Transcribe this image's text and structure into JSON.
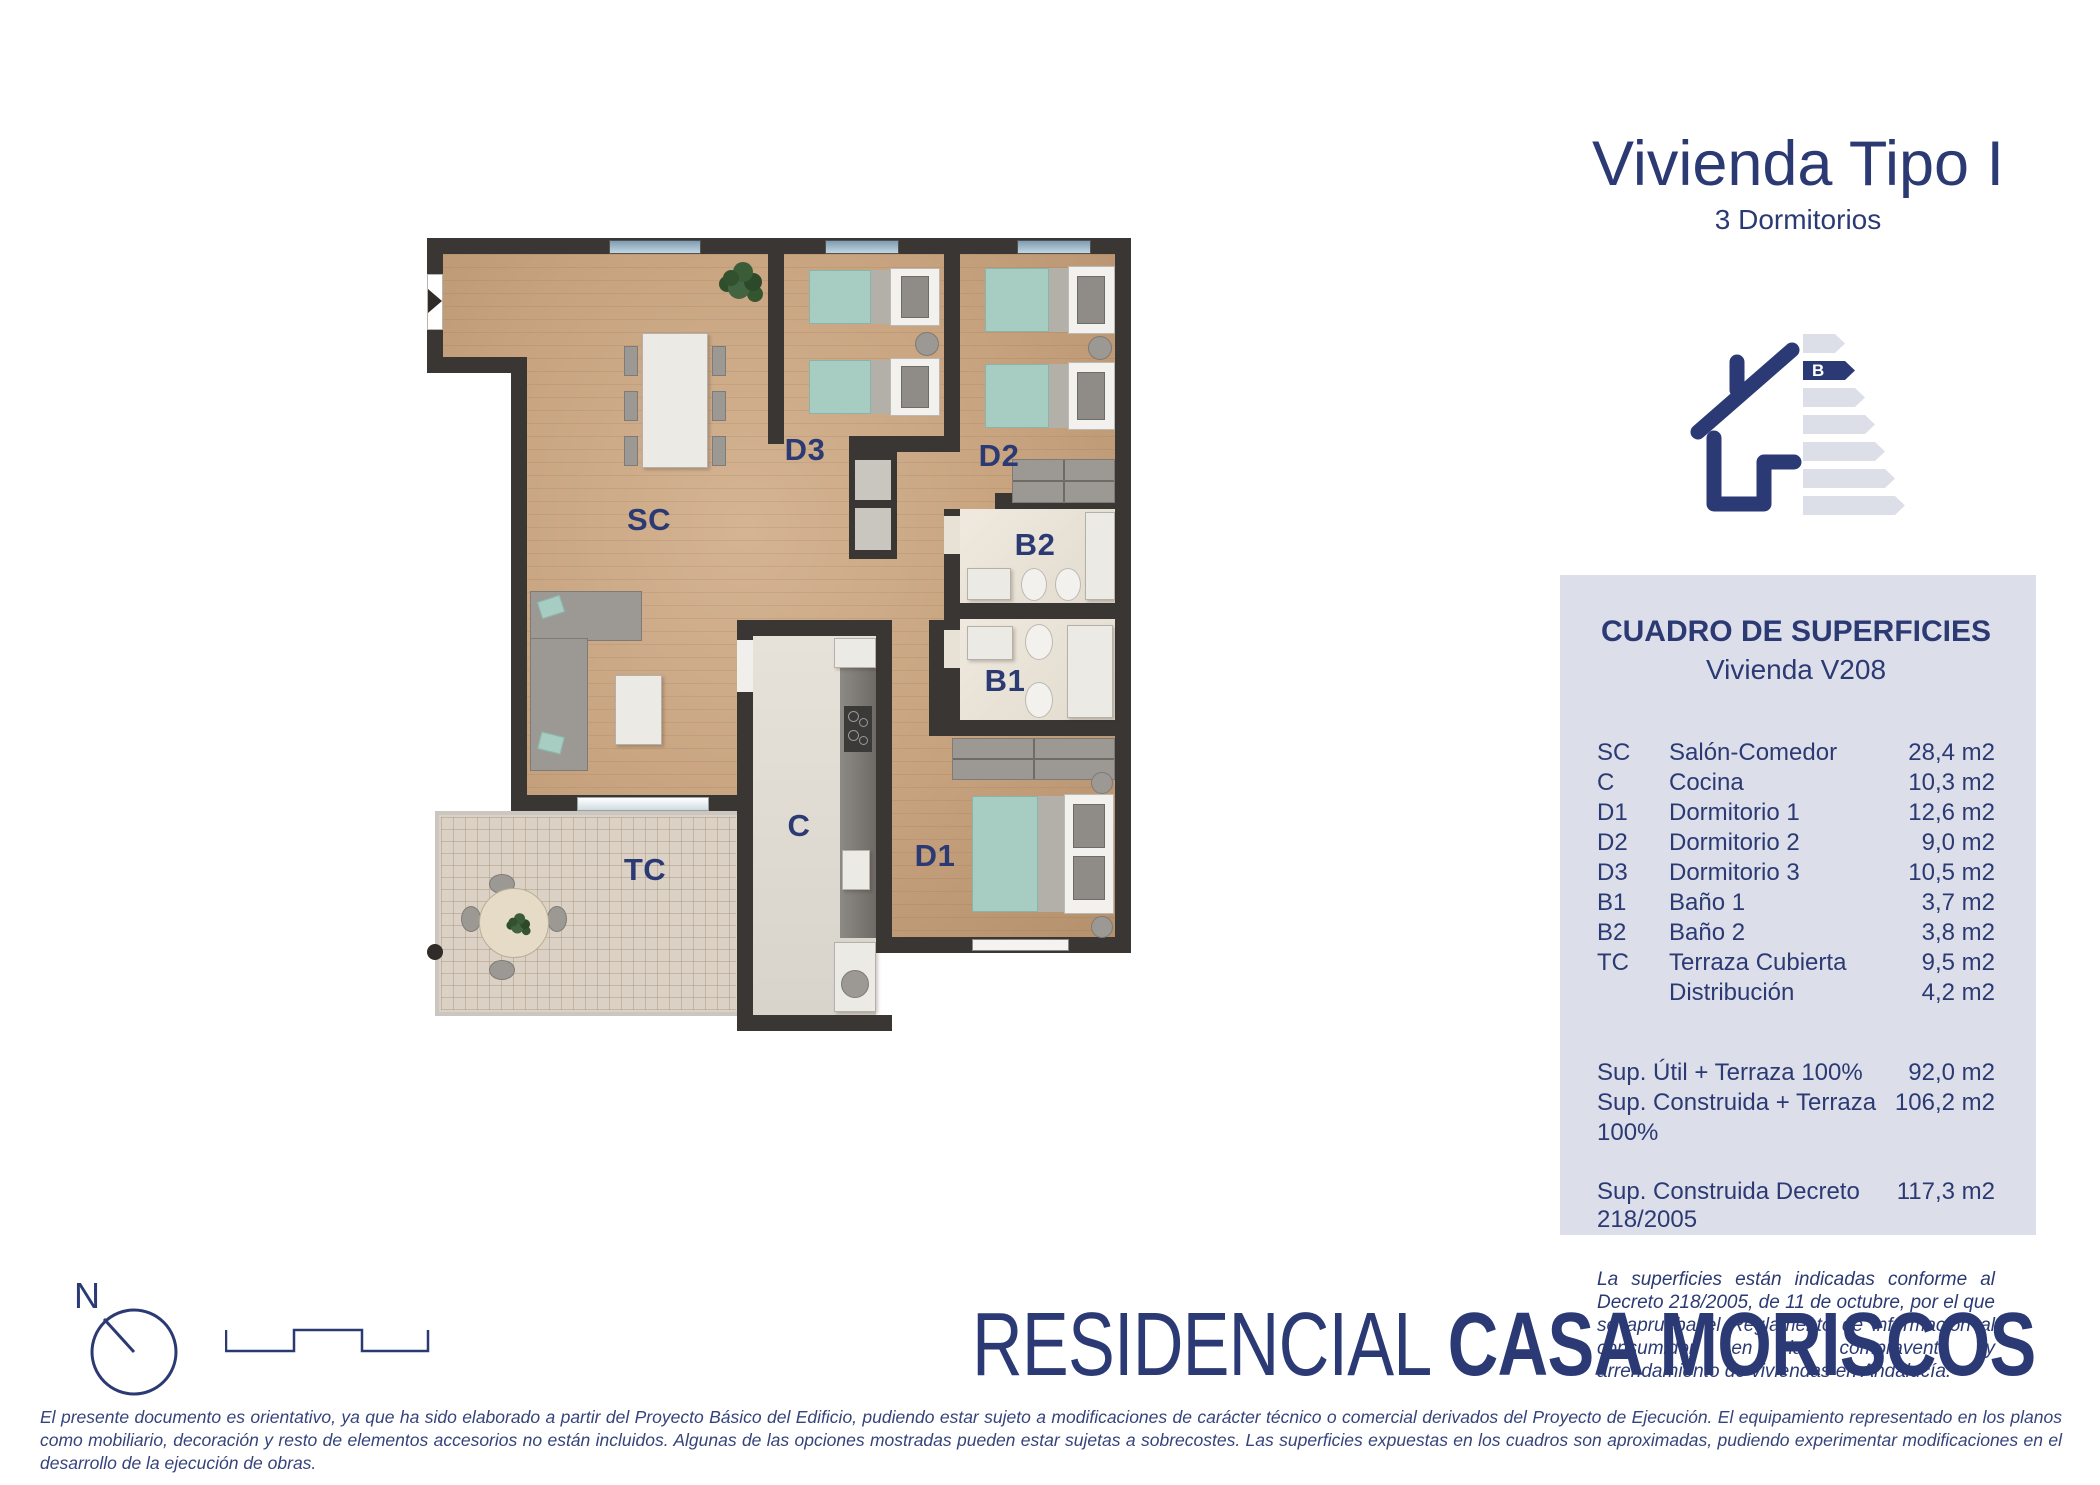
{
  "colors": {
    "navy": "#2c3a74",
    "panel_bg": "#dcdfe9",
    "wall": "#3a3633",
    "wood_floor": "#c7a27e",
    "bath_floor": "#e8e2d6",
    "kitchen_floor": "#ddd9d1",
    "terrace_floor": "#dbd2c5",
    "bed_teal": "#a7cdc3",
    "energy_bar_gray": "#dcdfe8"
  },
  "header": {
    "title": "Vivienda Tipo I",
    "subtitle": "3 Dormitorios"
  },
  "energy": {
    "rating": "B"
  },
  "panel": {
    "title": "CUADRO DE SUPERFICIES",
    "subtitle": "Vivienda V208",
    "rows": [
      {
        "code": "SC",
        "name": "Salón-Comedor",
        "area": "28,4 m2"
      },
      {
        "code": "C",
        "name": "Cocina",
        "area": "10,3 m2"
      },
      {
        "code": "D1",
        "name": "Dormitorio 1",
        "area": "12,6 m2"
      },
      {
        "code": "D2",
        "name": "Dormitorio 2",
        "area": "9,0 m2"
      },
      {
        "code": "D3",
        "name": "Dormitorio 3",
        "area": "10,5 m2"
      },
      {
        "code": "B1",
        "name": "Baño 1",
        "area": "3,7 m2"
      },
      {
        "code": "B2",
        "name": "Baño 2",
        "area": "3,8 m2"
      },
      {
        "code": "TC",
        "name": "Terraza Cubierta",
        "area": "9,5 m2"
      },
      {
        "code": "",
        "name": "Distribución",
        "area": "4,2 m2"
      }
    ],
    "totals": [
      {
        "name": "Sup. Útil + Terraza 100%",
        "area": "92,0 m2"
      },
      {
        "name": "Sup. Construida + Terraza 100%",
        "area": "106,2 m2"
      }
    ],
    "decree": {
      "name": "Sup. Construida Decreto 218/2005",
      "area": "117,3 m2"
    },
    "note": "La superficies están indicadas conforme al Decreto 218/2005, de 11 de octubre, por el que se aprueba el Reglamento de información al consumidor en la compraventa y arrendamiento de viviendas en Andalucía."
  },
  "plan": {
    "labels": {
      "sc": "SC",
      "c": "C",
      "d1": "D1",
      "d2": "D2",
      "d3": "D3",
      "b1": "B1",
      "b2": "B2",
      "tc": "TC"
    },
    "compass_n": "N"
  },
  "brand": {
    "light": "RESIDENCIAL ",
    "bold": "CASA MORISCOS"
  },
  "disclaimer": "El presente documento es orientativo, ya que ha sido elaborado a partir del Proyecto Básico del Edificio, pudiendo estar sujeto a modificaciones de carácter técnico o comercial derivados del Proyecto de Ejecución. El equipamiento representado en los planos como mobiliario, decoración y resto de elementos accesorios no están incluidos. Algunas de las opciones mostradas pueden estar sujetas a sobrecostes. Las superficies expuestas en los cuadros son aproximadas, pudiendo experimentar modificaciones en el desarrollo de la ejecución de obras."
}
